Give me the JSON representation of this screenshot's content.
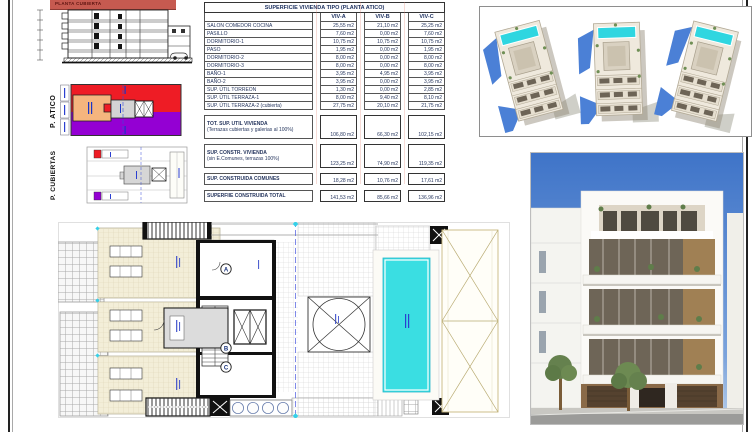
{
  "sheet": {
    "banner": "PLANTA CUBIERTA"
  },
  "mini_plans": {
    "atico_label": "P. ATICO",
    "cubiertas_label": "P. CUBIERTAS"
  },
  "table": {
    "title": "SUPERFICIE VIVIENDA TIPO (PLANTA ATICO)",
    "columns": [
      "VIV-A",
      "VIV-B",
      "VIV-C"
    ],
    "rows": [
      {
        "label": "SALON COMEDOR COCINA",
        "values": [
          "25,55 m2",
          "21,10 m2",
          "25,25 m2"
        ]
      },
      {
        "label": "PASILLO",
        "values": [
          "7,60 m2",
          "0,00 m2",
          "7,60 m2"
        ]
      },
      {
        "label": "DORMITORIO-1",
        "values": [
          "10,75 m2",
          "10,75 m2",
          "10,75 m2"
        ]
      },
      {
        "label": "PASO",
        "values": [
          "1,95 m2",
          "0,00 m2",
          "1,95 m2"
        ]
      },
      {
        "label": "DORMITORIO-2",
        "values": [
          "8,00 m2",
          "0,00 m2",
          "8,00 m2"
        ]
      },
      {
        "label": "DORMITORIO-3",
        "values": [
          "8,00 m2",
          "0,00 m2",
          "8,00 m2"
        ]
      },
      {
        "label": "BAÑO-1",
        "values": [
          "3,95 m2",
          "4,95 m2",
          "3,95 m2"
        ]
      },
      {
        "label": "BAÑO-2",
        "values": [
          "3,95 m2",
          "0,00 m2",
          "3,95 m2"
        ]
      },
      {
        "label": "SUP. ÚTIL TORREON",
        "values": [
          "1,30 m2",
          "0,00 m2",
          "2,85 m2"
        ]
      },
      {
        "label": "SUP. ÚTIL TERRAZA-1",
        "values": [
          "8,00 m2",
          "9,40 m2",
          "8,10 m2"
        ]
      },
      {
        "label": "SUP. ÚTIL TERRAZA-2 (cubierta)",
        "values": [
          "27,75 m2",
          "20,10 m2",
          "21,75 m2"
        ]
      }
    ],
    "summary": [
      {
        "label": "TOT. SUP. UTIL VIVIENDA",
        "sublabel": "(Terrazas cubiertas y galerias al 100%)",
        "values": [
          "106,80 m2",
          "66,30 m2",
          "102,15 m2"
        ]
      },
      {
        "label": "SUP. CONSTR. VIVIENDA",
        "sublabel": "(sin E.Comunes, terrazas 100%)",
        "values": [
          "123,25 m2",
          "74,90 m2",
          "119,35 m2"
        ]
      },
      {
        "label": "SUP. CONSTRUIDA COMUNES",
        "sublabel": "",
        "values": [
          "18,28 m2",
          "10,76 m2",
          "17,61 m2"
        ]
      },
      {
        "label": "SUPERFIIE CONSTRUIDA TOTAL",
        "sublabel": "",
        "values": [
          "141,53 m2",
          "85,66 m2",
          "136,96 m2"
        ]
      }
    ]
  },
  "floor_plan": {
    "markers": [
      "A",
      "B",
      "C"
    ]
  },
  "colors": {
    "viv_red": "#ee1c25",
    "viv_purple": "#9400d3",
    "viv_orange": "#f5b57e",
    "pool_cyan": "#3adee2",
    "banner_red": "#c65a50",
    "table_text": "#26365e"
  }
}
